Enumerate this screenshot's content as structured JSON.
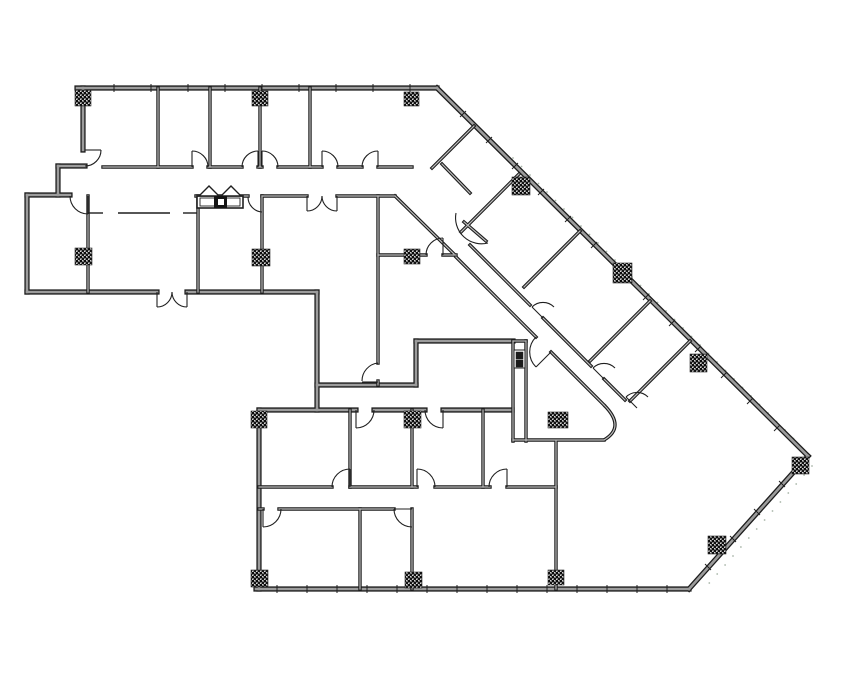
{
  "document": {
    "type": "architectural-floor-plan",
    "description": "black-and-white CAD office floor plan with diagonal wing",
    "canvas": {
      "width": 855,
      "height": 678,
      "background": "#ffffff"
    }
  },
  "colors": {
    "paper": "#ffffff",
    "wall_edge": "#1c1c1c",
    "wall_core_exterior": "#9c9c9c",
    "wall_core_interior": "#bdbdbd",
    "thin_line": "#1f1f1f",
    "survey_dots": "#a9b6a9",
    "column_fill_base": "#6b6b6b",
    "column_speckle": "#0a0a0a"
  },
  "geometry": {
    "walls_exterior": [
      [
        77,
        88,
        437,
        88
      ],
      [
        437,
        88,
        808,
        456
      ],
      [
        808,
        456,
        689,
        589
      ],
      [
        256,
        589,
        689,
        589
      ],
      [
        259,
        589,
        259,
        410
      ],
      [
        259,
        410,
        356,
        410
      ],
      [
        374,
        410,
        425,
        410
      ],
      [
        443,
        410,
        512,
        410
      ],
      [
        83,
        88,
        83,
        150
      ],
      [
        85,
        166,
        58,
        166
      ],
      [
        58,
        166,
        58,
        195
      ],
      [
        70,
        195,
        27,
        195
      ],
      [
        27,
        195,
        27,
        292
      ],
      [
        27,
        292,
        157,
        292
      ],
      [
        187,
        292,
        317,
        292
      ],
      [
        317,
        292,
        317,
        410
      ],
      [
        317,
        385,
        416,
        385
      ],
      [
        416,
        385,
        416,
        341
      ],
      [
        416,
        341,
        513,
        341
      ]
    ],
    "walls_interior": [
      [
        103,
        167,
        192,
        167
      ],
      [
        208,
        167,
        242,
        167
      ],
      [
        258,
        167,
        262,
        167
      ],
      [
        278,
        167,
        322,
        167
      ],
      [
        338,
        167,
        362,
        167
      ],
      [
        378,
        167,
        412,
        167
      ],
      [
        158,
        88,
        158,
        167
      ],
      [
        210,
        88,
        210,
        167
      ],
      [
        260,
        88,
        260,
        167
      ],
      [
        310,
        88,
        310,
        167
      ],
      [
        196,
        196,
        248,
        196
      ],
      [
        262,
        196,
        307,
        196
      ],
      [
        337,
        196,
        395,
        196
      ],
      [
        88,
        196,
        88,
        292
      ],
      [
        198,
        196,
        198,
        292
      ],
      [
        262,
        196,
        262,
        292
      ],
      [
        378,
        196,
        378,
        363
      ],
      [
        378,
        381,
        378,
        385
      ],
      [
        378,
        255,
        426,
        255
      ],
      [
        443,
        255,
        456,
        255
      ],
      [
        442,
        164,
        470,
        193
      ],
      [
        464,
        222,
        486,
        241
      ],
      [
        395,
        196,
        454,
        254
      ],
      [
        456,
        257,
        536,
        337
      ],
      [
        551,
        352,
        604,
        405
      ],
      [
        470,
        245,
        530,
        305
      ],
      [
        543,
        318,
        591,
        366
      ],
      [
        604,
        379,
        625,
        400
      ],
      [
        474,
        126,
        432,
        168
      ],
      [
        519,
        174,
        461,
        232
      ],
      [
        580,
        231,
        524,
        287
      ],
      [
        650,
        301,
        590,
        361
      ],
      [
        690,
        341,
        630,
        401
      ],
      [
        513,
        341,
        513,
        441
      ],
      [
        526,
        341,
        526,
        441
      ],
      [
        513,
        341,
        526,
        341
      ],
      [
        513,
        440,
        604,
        440
      ],
      [
        350,
        410,
        350,
        487
      ],
      [
        412,
        410,
        412,
        487
      ],
      [
        483,
        410,
        483,
        487
      ],
      [
        259,
        487,
        332,
        487
      ],
      [
        350,
        487,
        417,
        487
      ],
      [
        435,
        487,
        490,
        487
      ],
      [
        507,
        487,
        556,
        487
      ],
      [
        259,
        509,
        263,
        509
      ],
      [
        279,
        509,
        394,
        509
      ],
      [
        360,
        509,
        360,
        589
      ],
      [
        412,
        509,
        412,
        589
      ],
      [
        556,
        441,
        556,
        589
      ]
    ],
    "curve_paths": [
      "M604,405 Q626,427 604,440"
    ],
    "doors": [
      {
        "name": "office-nw-door",
        "leaf": [
          85,
          150,
          101,
          150
        ],
        "arc": "M101,150 A16 16 0 0 1 85,166"
      },
      {
        "name": "office-top-door-2",
        "leaf": [
          192,
          167,
          192,
          151
        ],
        "arc": "M192,151 A16 16 0 0 1 208,167"
      },
      {
        "name": "office-top-door-3",
        "leaf": [
          258,
          167,
          258,
          151
        ],
        "arc": "M258,151 A16 16 0 0 0 242,167"
      },
      {
        "name": "office-top-door-4",
        "leaf": [
          262,
          167,
          262,
          151
        ],
        "arc": "M262,151 A16 16 0 0 1 278,167"
      },
      {
        "name": "office-top-door-5",
        "leaf": [
          322,
          167,
          322,
          151
        ],
        "arc": "M322,151 A16 16 0 0 1 338,167"
      },
      {
        "name": "office-top-door-6",
        "leaf": [
          378,
          167,
          378,
          151
        ],
        "arc": "M378,151 A16 16 0 0 0 362,167"
      },
      {
        "name": "room-west-door",
        "leaf": [
          88,
          196,
          88,
          214
        ],
        "arc": "M70,196 A18 18 0 0 0 88,214"
      },
      {
        "name": "kitchen-door",
        "leaf": null,
        "arc": "M248,197 A15 15 0 0 0 262,212"
      },
      {
        "name": "corridor-double-door-left",
        "leaf": [
          307,
          196,
          307,
          211
        ],
        "arc": "M307,211 A15 15 0 0 0 322,196"
      },
      {
        "name": "corridor-double-door-right",
        "leaf": [
          337,
          196,
          337,
          211
        ],
        "arc": "M337,211 A15 15 0 0 1 322,196"
      },
      {
        "name": "exterior-double-door-left",
        "leaf": [
          157,
          292,
          157,
          307
        ],
        "arc": "M157,307 A15 15 0 0 0 172,292"
      },
      {
        "name": "exterior-double-door-right",
        "leaf": [
          187,
          292,
          187,
          307
        ],
        "arc": "M187,307 A15 15 0 0 1 172,292"
      },
      {
        "name": "mid-room-south-door",
        "leaf": [
          362,
          382,
          378,
          382
        ],
        "arc": "M378,363 A18 18 0 0 0 362,381"
      },
      {
        "name": "lower-corridor-door-1",
        "leaf": [
          356,
          410,
          356,
          428
        ],
        "arc": "M356,428 A18 18 0 0 0 374,410"
      },
      {
        "name": "lower-corridor-door-2",
        "leaf": [
          443,
          410,
          443,
          428
        ],
        "arc": "M443,428 A18 18 0 0 1 425,410"
      },
      {
        "name": "south-block-door-1",
        "leaf": [
          350,
          487,
          350,
          469
        ],
        "arc": "M350,469 A18 18 0 0 0 332,487"
      },
      {
        "name": "south-block-door-2",
        "leaf": [
          417,
          487,
          417,
          469
        ],
        "arc": "M417,469 A18 18 0 0 1 435,487"
      },
      {
        "name": "south-block-door-3",
        "leaf": [
          507,
          487,
          507,
          469
        ],
        "arc": "M507,469 A18 18 0 0 0 489,487"
      },
      {
        "name": "south-block-door-4",
        "leaf": [
          263,
          509,
          263,
          527
        ],
        "arc": "M263,527 A18 18 0 0 0 281,509"
      },
      {
        "name": "south-block-door-5",
        "leaf": [
          412,
          509,
          394,
          509
        ],
        "arc": "M394,509 A18 18 0 0 0 412,527"
      },
      {
        "name": "diag-room-door-1",
        "leaf": [
          543,
          318,
          532,
          307
        ],
        "arc": "M532,307 A15.6 15.6 0 0 1 554,307"
      },
      {
        "name": "diag-room-door-2",
        "leaf": [
          604,
          379,
          593,
          368
        ],
        "arc": "M593,368 A15.6 15.6 0 0 1 615,368"
      },
      {
        "name": "corridor-end-door",
        "leaf": [
          637,
          408,
          626,
          397
        ],
        "arc": "M626,397 A15.6 15.6 0 0 1 648,397"
      },
      {
        "name": "elevator-lobby-door",
        "leaf": [
          551,
          352,
          536,
          367
        ],
        "arc": "M536,337 A21 21 0 0 0 536,367"
      },
      {
        "name": "corridor-bend-door",
        "leaf": null,
        "arc": "M456,213 A26 26 0 0 0 488,243"
      },
      {
        "name": "mid-wall-door",
        "leaf": [
          443,
          255,
          443,
          238
        ],
        "arc": "M443,238 A17 17 0 0 0 426,255"
      }
    ],
    "columns": [
      [
        75,
        90,
        16,
        16
      ],
      [
        252,
        91,
        16,
        15
      ],
      [
        404,
        92,
        15,
        14
      ],
      [
        512,
        177,
        18,
        18
      ],
      [
        613,
        263,
        19,
        20
      ],
      [
        690,
        354,
        17,
        18
      ],
      [
        792,
        457,
        17,
        17
      ],
      [
        708,
        536,
        18,
        18
      ],
      [
        75,
        248,
        17,
        17
      ],
      [
        252,
        249,
        18,
        17
      ],
      [
        404,
        249,
        16,
        15
      ],
      [
        548,
        412,
        20,
        16
      ],
      [
        251,
        411,
        16,
        17
      ],
      [
        404,
        411,
        17,
        17
      ],
      [
        251,
        570,
        17,
        17
      ],
      [
        405,
        572,
        17,
        16
      ],
      [
        548,
        570,
        16,
        15
      ]
    ],
    "window_ticks": {
      "top": {
        "y": 88,
        "xs": [
          114,
          151,
          188,
          225,
          262,
          299,
          336,
          373,
          410
        ]
      },
      "bottom": {
        "y": 589,
        "xs": [
          277,
          307,
          337,
          367,
          397,
          427,
          457,
          487,
          517,
          547,
          577,
          607,
          637,
          667
        ]
      },
      "ne_diagonal": [
        [
          463,
          114
        ],
        [
          489,
          140
        ],
        [
          515,
          166
        ],
        [
          541,
          192
        ],
        [
          568,
          219
        ],
        [
          594,
          245
        ],
        [
          620,
          271
        ],
        [
          646,
          297
        ],
        [
          672,
          323
        ],
        [
          698,
          349
        ],
        [
          724,
          375
        ],
        [
          750,
          401
        ],
        [
          777,
          428
        ]
      ],
      "se_diagonal": [
        [
          782,
          484
        ],
        [
          757,
          512
        ],
        [
          733,
          539
        ],
        [
          708,
          567
        ]
      ]
    },
    "survey_dots": {
      "ne": {
        "start": [
          513,
          158
        ],
        "step": [
          8.5,
          8.5
        ],
        "count": 34
      },
      "se": {
        "start": [
          812,
          466
        ],
        "step": [
          -7.9,
          9.0
        ],
        "count": 14
      }
    },
    "counter_dashes": [
      [
        88,
        213,
        103,
        213
      ],
      [
        118,
        213,
        170,
        213
      ],
      [
        183,
        213,
        197,
        213
      ]
    ],
    "kitchen_sink": {
      "outer_rect": [
        197,
        196,
        46,
        12
      ],
      "inner_rect": [
        200,
        198,
        40,
        8
      ],
      "triangle_left": [
        [
          199,
          196
        ],
        [
          219,
          196
        ],
        [
          209,
          186
        ]
      ],
      "triangle_right": [
        [
          221,
          196
        ],
        [
          241,
          196
        ],
        [
          231,
          186
        ]
      ],
      "faucet_square": [
        214,
        196,
        13,
        12
      ],
      "faucet_inner": [
        218,
        199,
        6,
        6
      ]
    },
    "elevator": {
      "car_box": [
        514,
        350,
        11,
        18
      ],
      "cell_top": [
        516,
        352,
        7,
        7
      ],
      "cell_bottom": [
        516,
        360,
        7,
        7
      ]
    }
  }
}
